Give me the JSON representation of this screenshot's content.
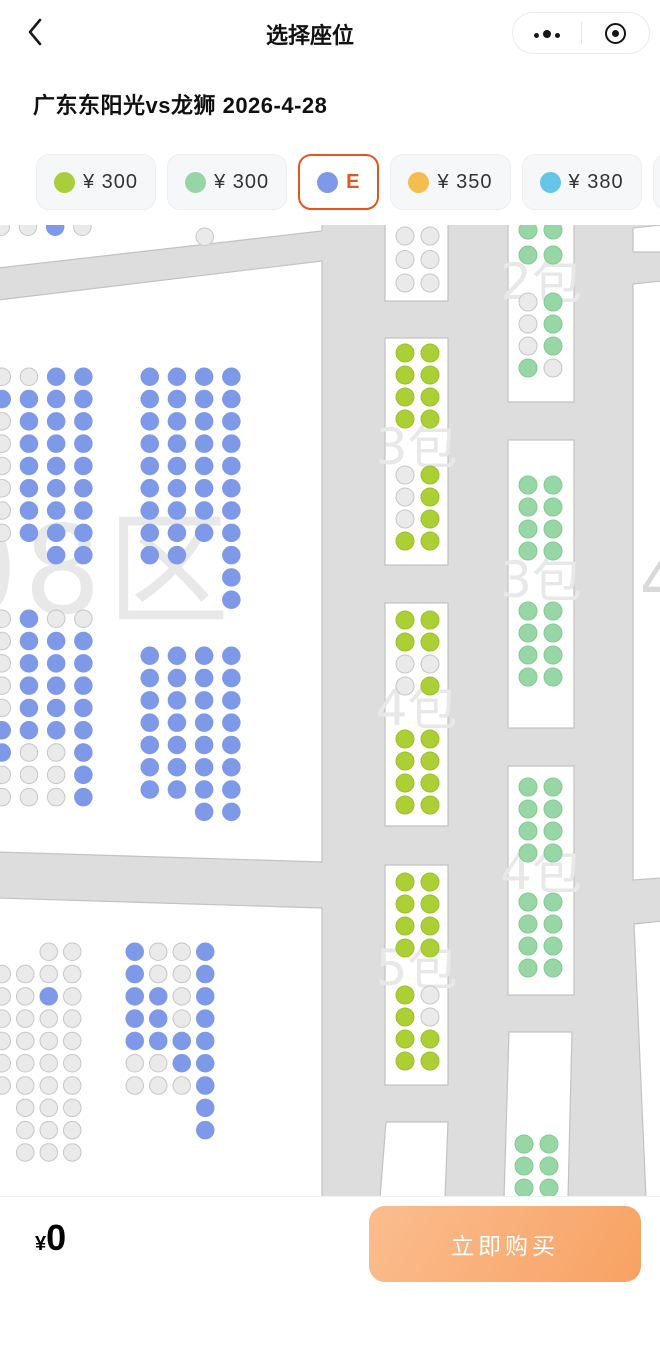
{
  "navbar": {
    "title": "选择座位",
    "back_icon": "chevron-left",
    "more_icon": "three-dots-menu",
    "record_icon": "record-circle"
  },
  "event": {
    "title": "广东东阳光vs龙狮 2026-4-28"
  },
  "tiers": [
    {
      "dot_color": "#a9ce3b",
      "label": "¥ 300",
      "selected": false
    },
    {
      "dot_color": "#95d6a4",
      "label": "¥ 300",
      "selected": false
    },
    {
      "dot_color": "#7d99e8",
      "label": "E",
      "selected": true
    },
    {
      "dot_color": "#f4be4e",
      "label": "¥ 350",
      "selected": false
    },
    {
      "dot_color": "#66c6e8",
      "label": "¥ 380",
      "selected": false
    },
    {
      "dot_color": "#e9ebee",
      "label": "",
      "selected": false,
      "partial": true
    }
  ],
  "footer": {
    "currency": "¥",
    "total": "0",
    "buy_label": "立即购买"
  },
  "seat_map": {
    "bg": "#dcdddc",
    "section_fill": "#ffffff",
    "section_stroke": "#c2c2c2",
    "watermark_color": "#e8e8e8",
    "box_wm_size": 50,
    "box_col_off": [
      11,
      36
    ],
    "seat_fill": {
      "b": "#7d99e8",
      "g": "#eaeaea",
      "G": "#96d7a5",
      "Y": "#abcf35"
    },
    "seat_stroke": {
      "b": "#7d99e8",
      "g": "#c7c7c7",
      "G": "#83ca95",
      "Y": "#9dc02c"
    },
    "tier_of_color": {
      "Y": "¥300",
      "G": "¥300",
      "b": "E",
      "g": "sold-out"
    },
    "sections": [
      {
        "name": "top-left-sliver",
        "points": [
          [
            -2,
            -2
          ],
          [
            322,
            -2
          ],
          [
            322,
            6
          ],
          [
            -2,
            43
          ]
        ]
      },
      {
        "name": "left-main-08",
        "points": [
          [
            -2,
            75
          ],
          [
            322,
            36
          ],
          [
            322,
            637
          ],
          [
            -2,
            627
          ]
        ]
      },
      {
        "name": "bottom-left",
        "points": [
          [
            -2,
            673
          ],
          [
            322,
            683
          ],
          [
            322,
            973
          ],
          [
            -2,
            973
          ]
        ]
      },
      {
        "name": "right-edge-top",
        "points": [
          [
            633,
            3
          ],
          [
            662,
            0
          ],
          [
            662,
            27
          ],
          [
            633,
            27
          ]
        ]
      },
      {
        "name": "right-edge-mid",
        "points": [
          [
            633,
            59
          ],
          [
            662,
            56
          ],
          [
            662,
            653
          ],
          [
            633,
            655
          ]
        ]
      },
      {
        "name": "right-edge-bottom",
        "points": [
          [
            634,
            699
          ],
          [
            662,
            696
          ],
          [
            662,
            973
          ],
          [
            646,
            973
          ]
        ]
      }
    ],
    "watermarks": [
      {
        "text": "08区",
        "x": -60,
        "y": 388,
        "size": 122,
        "spacing": 6
      },
      {
        "text": "4",
        "x": 640,
        "y": 378,
        "size": 64,
        "color": "#d8d8d8"
      }
    ],
    "boxes": [
      {
        "name": "mid-top",
        "rect": [
          385,
          -8,
          63,
          84
        ],
        "blocks": [
          {
            "dy": 10,
            "rows": [
              "gg",
              "gg",
              "gg"
            ],
            "pitch": 23.5
          }
        ]
      },
      {
        "name": "mid-3bao",
        "rect": [
          385,
          113,
          63,
          227
        ],
        "wm": {
          "text": "3包",
          "dy": 126
        },
        "blocks": [
          {
            "dy": 6,
            "rows": [
              "YY",
              "YY",
              "YY",
              "YY"
            ]
          },
          {
            "dy": 128,
            "rows": [
              "gY",
              "gY",
              "gY",
              "YY"
            ]
          }
        ]
      },
      {
        "name": "mid-4bao",
        "rect": [
          385,
          378,
          63,
          223
        ],
        "wm": {
          "text": "4包",
          "dy": 122
        },
        "blocks": [
          {
            "dy": 8,
            "rows": [
              "YY",
              "YY",
              "gg",
              "gY"
            ]
          },
          {
            "dy": 127,
            "rows": [
              "YY",
              "YY",
              "YY",
              "YY"
            ]
          }
        ]
      },
      {
        "name": "mid-5bao",
        "rect": [
          385,
          640,
          63,
          220
        ],
        "wm": {
          "text": "5包",
          "dy": 120
        },
        "blocks": [
          {
            "dy": 8,
            "rows": [
              "YY",
              "YY",
              "YY",
              "YY"
            ]
          },
          {
            "dy": 121,
            "rows": [
              "Yg",
              "Yg",
              "YY",
              "YY"
            ]
          }
        ]
      },
      {
        "name": "mid-bottom",
        "points": [
          [
            386,
            897
          ],
          [
            448,
            897
          ],
          [
            445,
            973
          ],
          [
            380,
            973
          ]
        ],
        "blocks": []
      },
      {
        "name": "right-2bao",
        "rect": [
          508,
          -8,
          66,
          185
        ],
        "wm": {
          "text": "2包",
          "dy": 82
        },
        "blocks": [
          {
            "dy": 4,
            "rows": [
              "GG",
              "GG"
            ],
            "pitch": 25
          },
          {
            "dy": 76,
            "rows": [
              "gG",
              "gG",
              "gG",
              "Gg"
            ]
          }
        ]
      },
      {
        "name": "right-3bao",
        "rect": [
          508,
          215,
          66,
          288
        ],
        "wm": {
          "text": "3包",
          "dy": 157
        },
        "blocks": [
          {
            "dy": 36,
            "rows": [
              "GG",
              "GG",
              "GG",
              "GG"
            ]
          },
          {
            "dy": 162,
            "rows": [
              "GG",
              "GG",
              "GG",
              "GG"
            ]
          }
        ]
      },
      {
        "name": "right-4bao",
        "rect": [
          508,
          541,
          66,
          229
        ],
        "wm": {
          "text": "4包",
          "dy": 123
        },
        "blocks": [
          {
            "dy": 12,
            "rows": [
              "GG",
              "GG",
              "GG",
              "GG"
            ]
          },
          {
            "dy": 127,
            "rows": [
              "GG",
              "GG",
              "GG",
              "GG"
            ]
          }
        ]
      },
      {
        "name": "right-bottom",
        "points": [
          [
            509,
            807
          ],
          [
            572,
            807
          ],
          [
            568,
            973
          ],
          [
            504,
            973
          ]
        ],
        "blocks": [
          {
            "dy": 103,
            "rows": [
              "GG",
              "GG",
              "GG"
            ]
          }
        ]
      }
    ],
    "clusters": [
      {
        "name": "sliver-row",
        "x": -8,
        "y": -7,
        "rows": [
          "ggbg"
        ]
      },
      {
        "name": "left-upper-west",
        "x": -7,
        "y": 143,
        "rows": [
          "ggbb",
          "bbbb",
          "gbbb",
          "gbbb",
          "gbbb",
          "gbbb",
          "gbbb",
          "gbbb",
          "..bb"
        ]
      },
      {
        "name": "left-lower-west",
        "x": -7,
        "y": 385,
        "rows": [
          "gbgg",
          "gbbb",
          "gbbb",
          "gbbb",
          "gbbb",
          "bbbb",
          "bggb",
          "gggb",
          "gggb"
        ]
      },
      {
        "name": "left-upper-east",
        "x": 141,
        "y": 143,
        "rows": [
          "bbbb",
          "bbbb",
          "bbbb",
          "bbbb",
          "bbbb",
          "bbbb",
          "bbbb",
          "bbbb",
          "bb.b",
          "...b",
          "...b"
        ]
      },
      {
        "name": "left-lower-east",
        "x": 141,
        "y": 422,
        "rows": [
          "bbbb",
          "bbbb",
          "bbbb",
          "bbbb",
          "bbbb",
          "bbbb",
          "bbbb",
          "..bb"
        ]
      },
      {
        "name": "bottom-west",
        "x": -7,
        "y": 718,
        "col_pitch": 23.5,
        "rows": [
          "..gg",
          "gggg",
          "ggbg",
          "gggg",
          "gggg",
          "gggg",
          "gggg",
          ".ggg",
          ".ggg",
          ".ggg"
        ]
      },
      {
        "name": "bottom-east",
        "x": 126,
        "y": 718,
        "col_pitch": 23.5,
        "rows": [
          "bggb",
          "bggb",
          "bbgb",
          "bbgb",
          "bbbb",
          "ggbb",
          "gggb",
          "...b",
          "...b"
        ]
      }
    ],
    "singles": [
      {
        "x": 196,
        "y": 3,
        "c": "g"
      }
    ]
  }
}
